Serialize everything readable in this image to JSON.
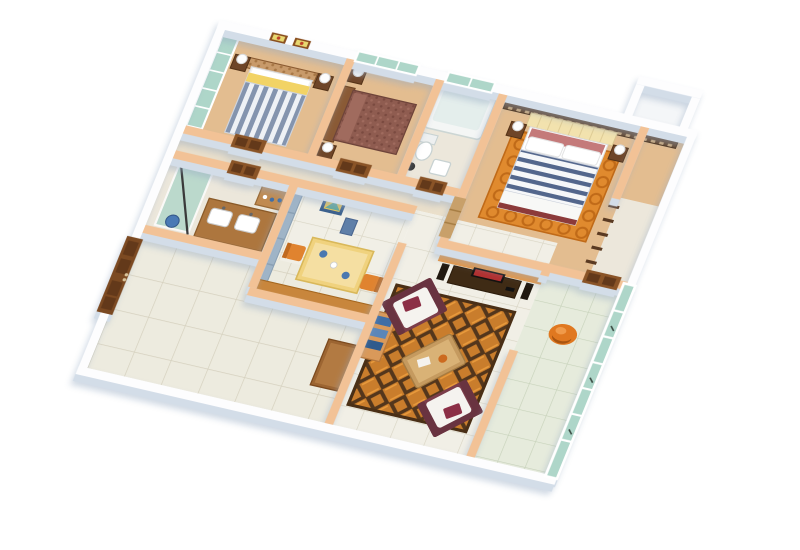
{
  "meta": {
    "kind": "3d-floor-plan-rendering",
    "view": "isometric-cutaway",
    "background": "white"
  },
  "palette": {
    "bg": "#ffffff",
    "wall-top": "#fdfdfe",
    "wall-peach": "#f2c296",
    "wall-shadow": "#d3dde8",
    "floor-wood": "#e3bd90",
    "floor-bath": "#ece7db",
    "floor-corridor": "#eadfca",
    "floor-tile": "#f1efe6",
    "floor-terrace": "#edebdf",
    "floor-balcony": "#e6ebdc",
    "tile-line": "#d8d4c3",
    "teal-glass": "#aed6c9",
    "door-brown": "#8a5427",
    "door-dark": "#63391a",
    "headboard-brown": "#9c6b43",
    "pillow-yellow": "#f2d365",
    "stripe-blue": "#8494ae",
    "maroon-bed": "#8f5c50",
    "lattice-brown": "#5f4026",
    "headboard-cream": "#f2e2ae",
    "master-rose": "#c47a7a",
    "stripe-navy": "#53668c",
    "rug-orange": "#e08a2e",
    "rug-swirl": "#c06a18",
    "weave-orange": "#c97d2c",
    "weave-dark": "#53361c",
    "sofa-maroon": "#7b3d4a",
    "sofa-white": "#f5f3ef",
    "table-wood": "#c59a5f",
    "media-orange": "#e9953f",
    "media-cream": "#f2e3c4",
    "tv-black": "#141210",
    "tv-screen-red": "#b03030",
    "dining-yellow": "#f0d27e",
    "chair-orange": "#e0832f",
    "cabinet-blue": "#9fb4c7",
    "shelf-orange": "#d9995a",
    "book-blue": "#3f6ea6",
    "vanity-brown": "#ad763e",
    "furniture-dark": "#6e4528",
    "balcony-chair-orange": "#e07820"
  },
  "scene": {
    "description": "isometric cutaway 3D render of an apartment floor plan, no text labels",
    "rooms": [
      {
        "name": "bedroom-1",
        "floor": "wood",
        "furniture": [
          "teal-sliding-wardrobe",
          "double-bed-grey-striped-duvet-yellow-pillows",
          "patterned-headboard",
          "two-framed-wall-pictures",
          "nightstands-with-lamps"
        ]
      },
      {
        "name": "bedroom-2",
        "floor": "wood",
        "furniture": [
          "maroon-upholstered-bed",
          "teal-window",
          "nightstands-with-lamps"
        ]
      },
      {
        "name": "bathroom-1",
        "floor": "tile",
        "furniture": [
          "bathtub",
          "toilet",
          "wash-basin",
          "teal-window"
        ]
      },
      {
        "name": "master-bedroom",
        "floor": "wood",
        "furniture": [
          "dark-lattice-screen-wall",
          "cream-tufted-headboard",
          "double-bed-navy-striped-duvet",
          "rose-and-white-pillows",
          "orange-swirl-rug",
          "nightstands-with-lamps",
          "closet-door",
          "utility-box"
        ]
      },
      {
        "name": "corridor",
        "floor": "tile",
        "furniture": [
          "bedroom-doors",
          "bathroom-doors"
        ]
      },
      {
        "name": "bathroom-2",
        "floor": "tile",
        "furniture": [
          "glass-shower-screen",
          "towel-rail",
          "vanity-with-two-sinks",
          "bottle-shelf",
          "blue-bucket"
        ]
      },
      {
        "name": "kitchen-dining",
        "floor": "tile",
        "furniture": [
          "blue-cabinet-wall",
          "wall-art-frame",
          "blue-bin",
          "yellow-dining-table",
          "blue-dishes",
          "two-orange-chairs",
          "counter"
        ]
      },
      {
        "name": "living-room",
        "floor": "tile",
        "furniture": [
          "orange-media-wall",
          "tv-console",
          "flat-tv",
          "speakers",
          "two-maroon-white-sofas",
          "wooden-coffee-table",
          "basket-weave-orange-rug",
          "orange-bookshelf-with-blue-books"
        ]
      },
      {
        "name": "balcony",
        "floor": "green-tile",
        "furniture": [
          "teal-glass-curtain-wall",
          "orange-lounge-chair"
        ]
      },
      {
        "name": "entrance-hall-terrace",
        "floor": "tile",
        "furniture": [
          "large-brown-double-entrance-door",
          "side-counter"
        ]
      }
    ]
  }
}
